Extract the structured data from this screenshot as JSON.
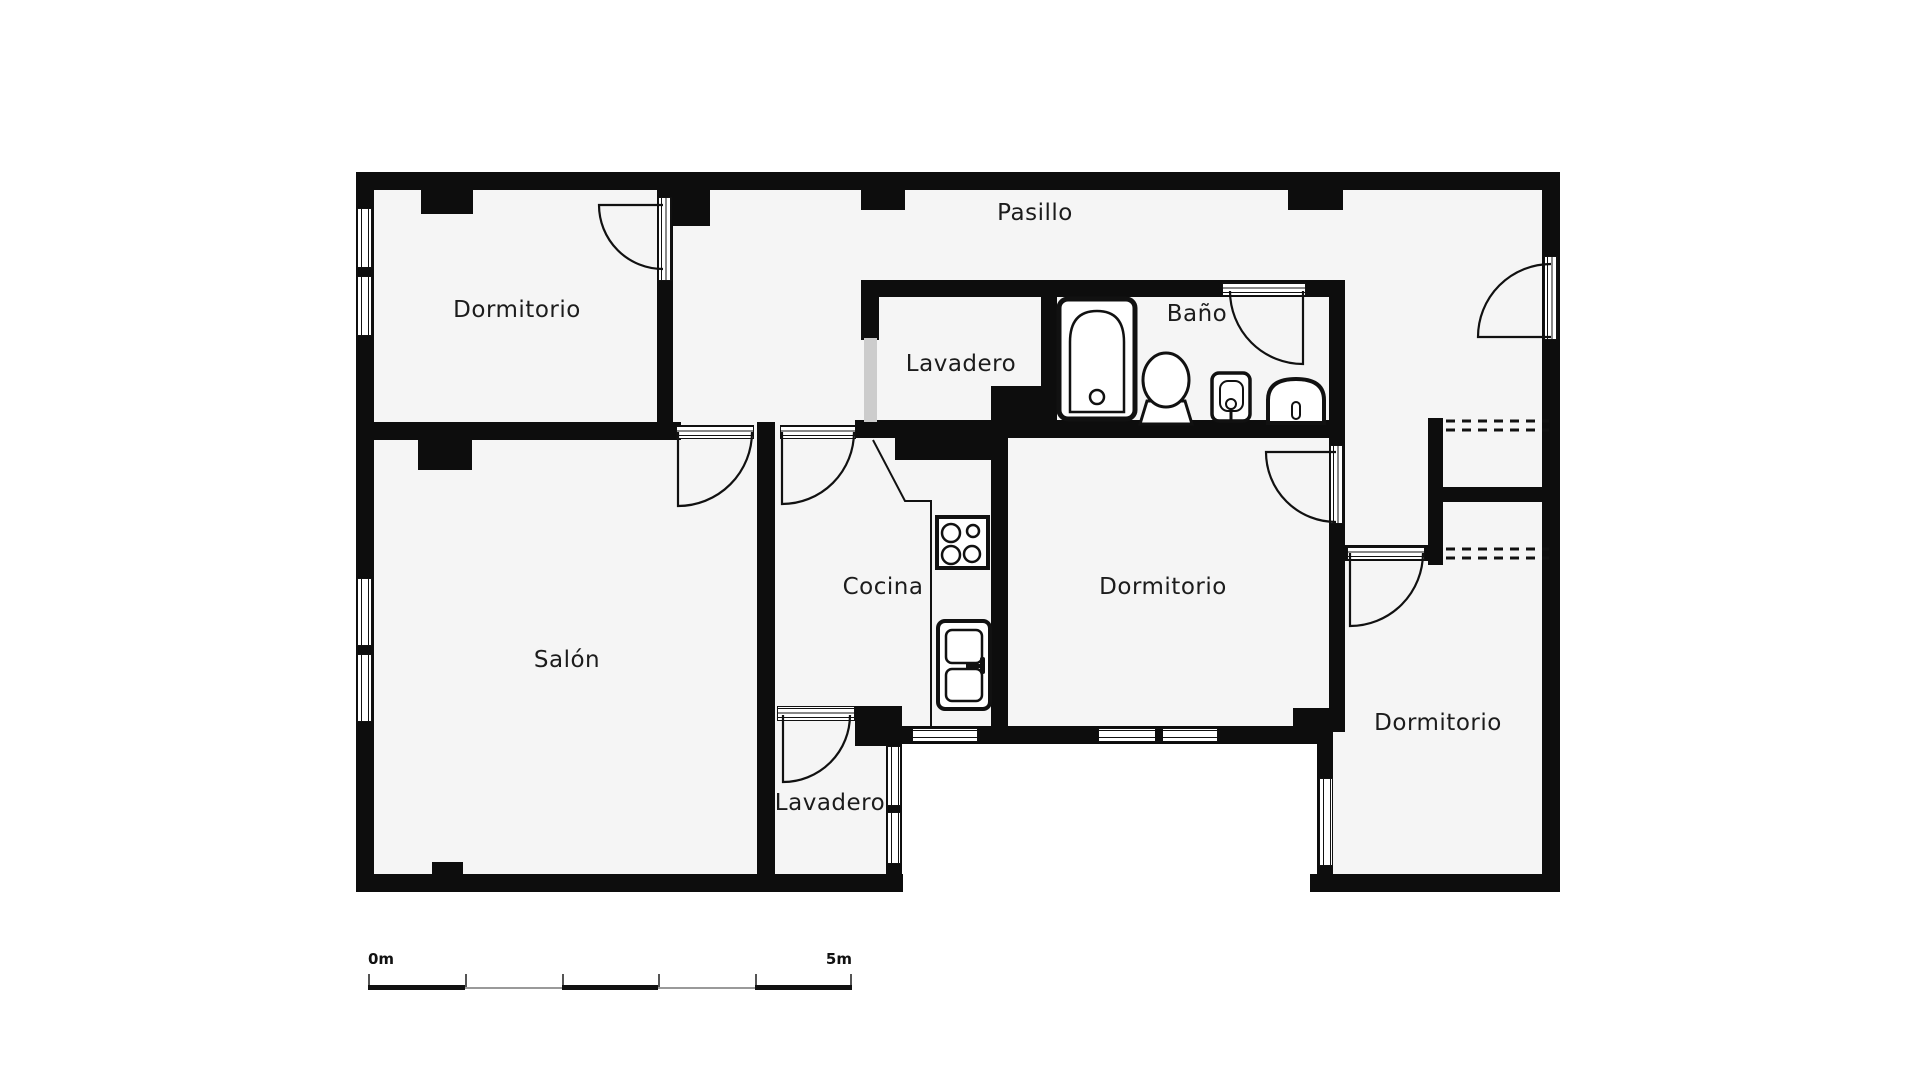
{
  "plan": {
    "type": "floor-plan",
    "rooms": [
      {
        "name": "Pasillo"
      },
      {
        "name": "Dormitorio"
      },
      {
        "name": "Lavadero"
      },
      {
        "name": "Baño"
      },
      {
        "name": "Salón"
      },
      {
        "name": "Cocina"
      },
      {
        "name": "Dormitorio"
      },
      {
        "name": "Dormitorio"
      },
      {
        "name": "Lavadero"
      }
    ],
    "scale_bar": {
      "start_label": "0m",
      "end_label": "5m"
    },
    "colors": {
      "wall": "#0d0d0d",
      "floor": "#f5f5f5",
      "background": "#ffffff",
      "opening_gray": "#cccccc",
      "line": "#111111"
    },
    "icons": [
      "bathtub-icon",
      "toilet-icon",
      "washbasin-icon",
      "bidet-icon",
      "stove-icon",
      "refrigerator-icon",
      "door-swing-icon",
      "window-icon",
      "closet-dashed-icon"
    ]
  }
}
